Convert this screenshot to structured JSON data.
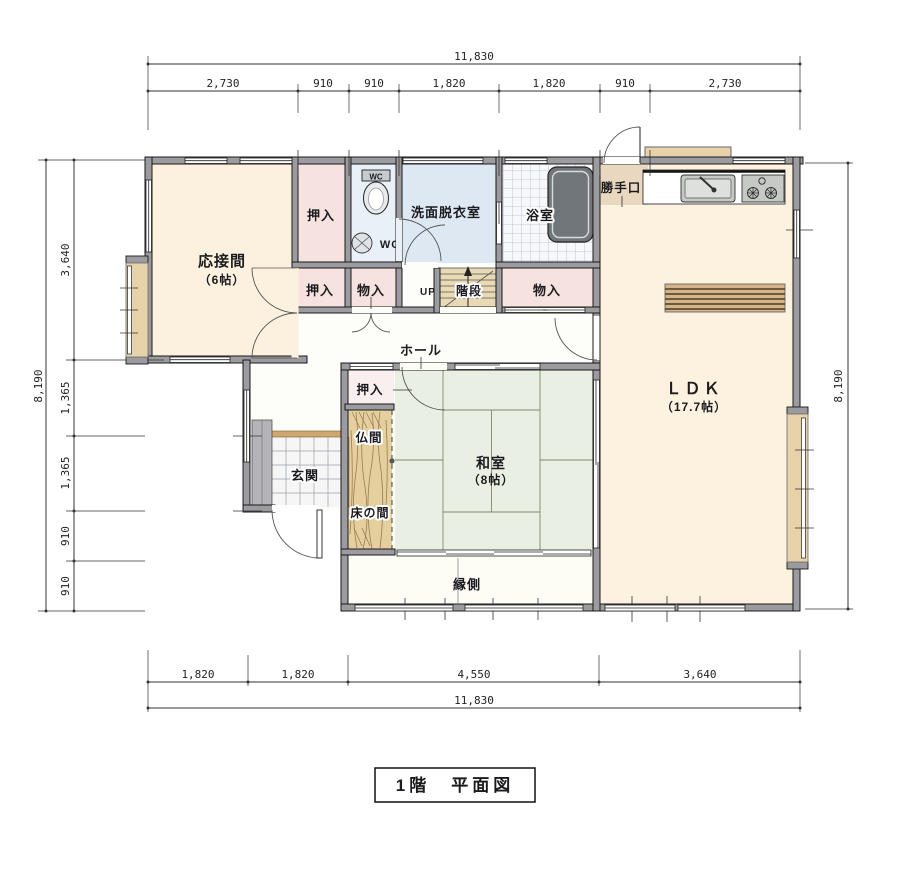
{
  "title": "1階　平面図",
  "dims": {
    "top_total": "11,830",
    "top": [
      "2,730",
      "910",
      "910",
      "1,820",
      "1,820",
      "910",
      "2,730"
    ],
    "bottom": [
      "1,820",
      "1,820",
      "4,550",
      "3,640"
    ],
    "bottom_total": "11,830",
    "left": [
      "3,640",
      "1,365",
      "1,365",
      "910",
      "910"
    ],
    "left_total": "8,190",
    "right_total": "8,190"
  },
  "rooms": {
    "reception_name": "応接間",
    "reception_size": "（6帖）",
    "oshiire_top": "押入",
    "oshiire_mid": "押入",
    "monoire_mid": "物入",
    "wc_upper": "WC",
    "wc_lower": "WC",
    "washroom": "洗面脱衣室",
    "bath": "浴室",
    "backdoor": "勝手口",
    "monoire_right": "物入",
    "stairs_up": "UP",
    "stairs": "階段",
    "hall": "ホール",
    "ldk_name": "ＬＤＫ",
    "ldk_size": "（17.7帖）",
    "oshiire_center": "押入",
    "butsuma": "仏間",
    "genkan": "玄関",
    "tokonoma": "床の間",
    "washitsu_name": "和室",
    "washitsu_size": "（8帖）",
    "engawa": "縁側"
  },
  "colors": {
    "wall": "#9c9ca0",
    "room_cream": "#fbf1de",
    "closet_pink": "#f6e3e0",
    "washroom_blue": "#dee8f3",
    "tatami_green": "#e9f0e3",
    "wood_tan": "#e5cf9f",
    "bay_tan": "#e8d2aa",
    "tile_line": "#b6bcc8"
  }
}
